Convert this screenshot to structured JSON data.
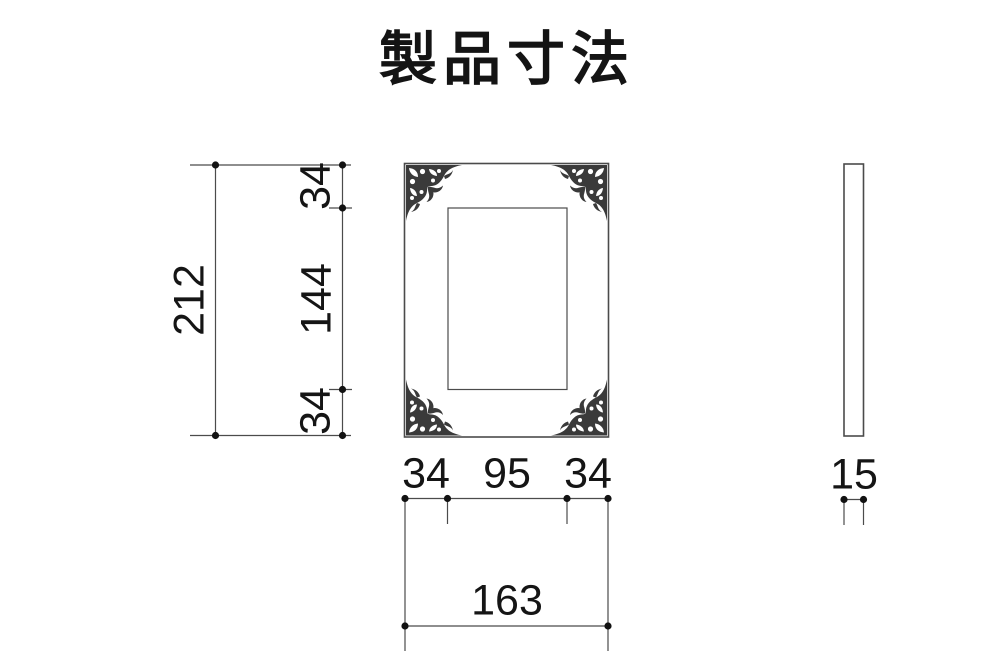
{
  "title": "製品寸法",
  "colors": {
    "background": "#ffffff",
    "line": "#4b4b4b",
    "ornament": "#3a3a3a",
    "text": "#151515"
  },
  "front_view": {
    "description": "front elevation of ornate photo frame with decorative corners",
    "dimensions": {
      "overall_height": "212",
      "frame_top_border": "34",
      "opening_height": "144",
      "frame_bottom_border": "34",
      "frame_left_border": "34",
      "opening_width": "95",
      "frame_right_border": "34",
      "overall_width": "163"
    }
  },
  "side_view": {
    "description": "side elevation of frame",
    "dimensions": {
      "thickness": "15"
    }
  }
}
